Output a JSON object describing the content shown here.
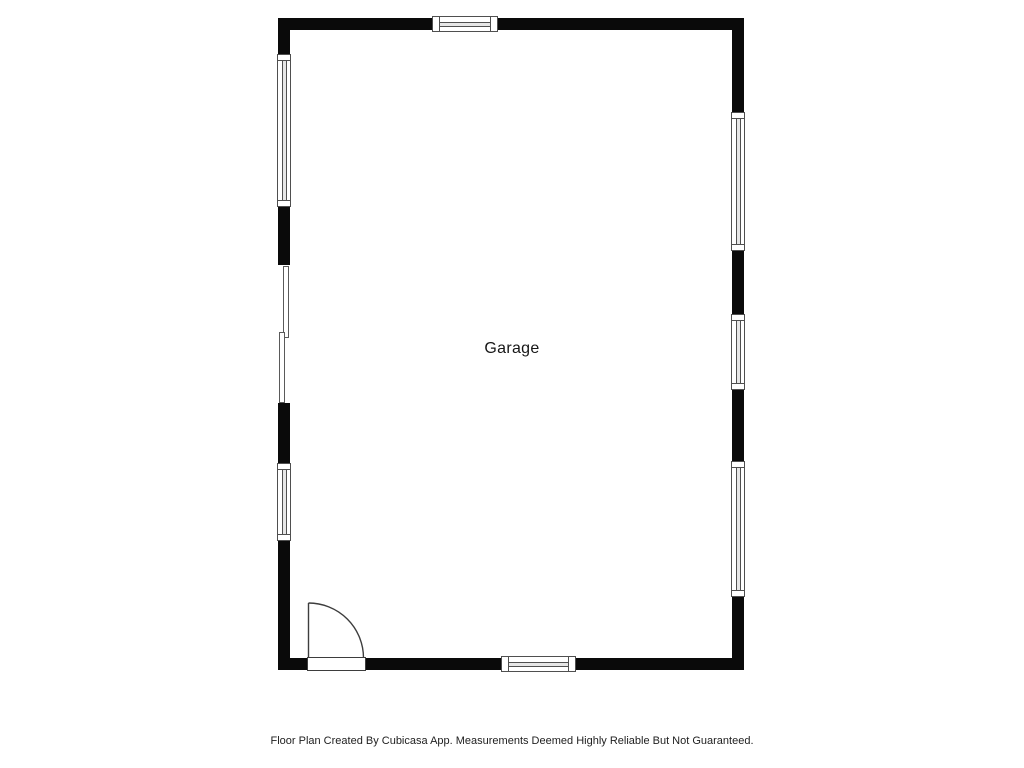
{
  "floor_plan": {
    "room_label": "Garage",
    "footer_disclaimer": "Floor Plan Created By Cubicasa App. Measurements Deemed Highly Reliable But Not Guaranteed.",
    "colors": {
      "wall": "#0a0a0a",
      "floor": "#ffffff",
      "window-outline": "#4f4f4f",
      "window-fill": "#ffffff",
      "window-rail": "#e6e6e6",
      "opening-line": "#5a5a5a",
      "door-line": "#3d3d3d",
      "label-text": "#161616",
      "footer-text": "#1e1e1e"
    }
  }
}
